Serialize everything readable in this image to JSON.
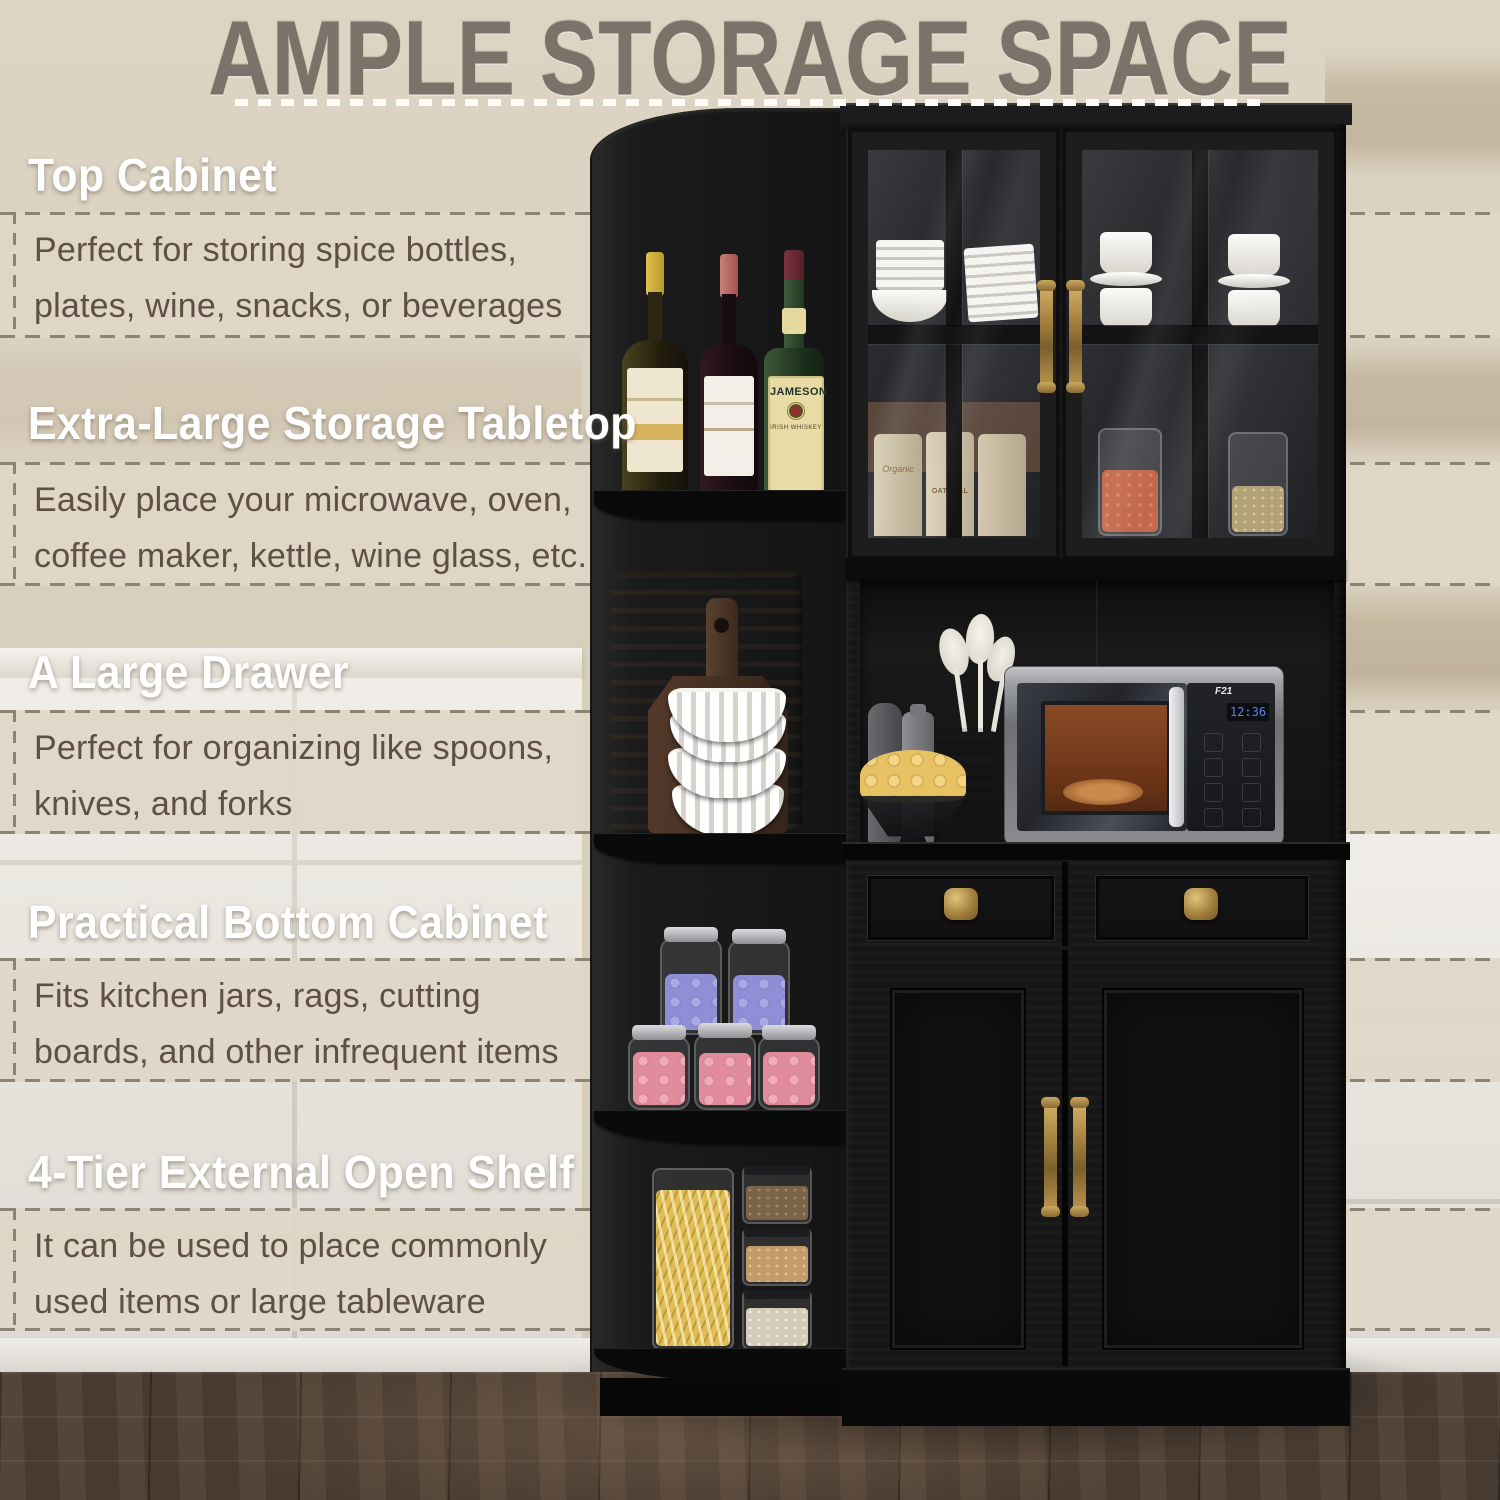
{
  "title": {
    "text": "AMPLE STORAGE SPACE"
  },
  "sections": [
    {
      "heading": "Top Cabinet",
      "line1": "Perfect for storing spice bottles,",
      "line2": "plates, wine, snacks, or beverages"
    },
    {
      "heading": "Extra-Large Storage Tabletop",
      "line1": "Easily place your microwave, oven,",
      "line2": "coffee maker, kettle, wine glass, etc."
    },
    {
      "heading": "A Large Drawer",
      "line1": "Perfect for organizing like spoons,",
      "line2": "knives, and forks"
    },
    {
      "heading": "Practical Bottom Cabinet",
      "line1": "Fits kitchen jars, rags, cutting",
      "line2": "boards, and other infrequent items"
    },
    {
      "heading": "4-Tier External Open Shelf",
      "line1": "It can be used to place commonly",
      "line2": "used items or large tableware"
    }
  ],
  "photo": {
    "whiskey_label": "JAMESON",
    "whiskey_sub": "IRISH WHISKEY",
    "canister_script": "Organic",
    "canister_label": "OATMEAL",
    "microwave_display": "12:36",
    "microwave_badge": "F21"
  },
  "colors": {
    "wall_beige": "#d8cebc",
    "strip_beige": "#dfd6c6",
    "dash_gray": "#8c8374",
    "body_text": "#5e5044",
    "title_gray": "#7b7369",
    "cabinet_black": "#161616",
    "brass": "#b3914f",
    "floor_brown": "#4d4036"
  }
}
